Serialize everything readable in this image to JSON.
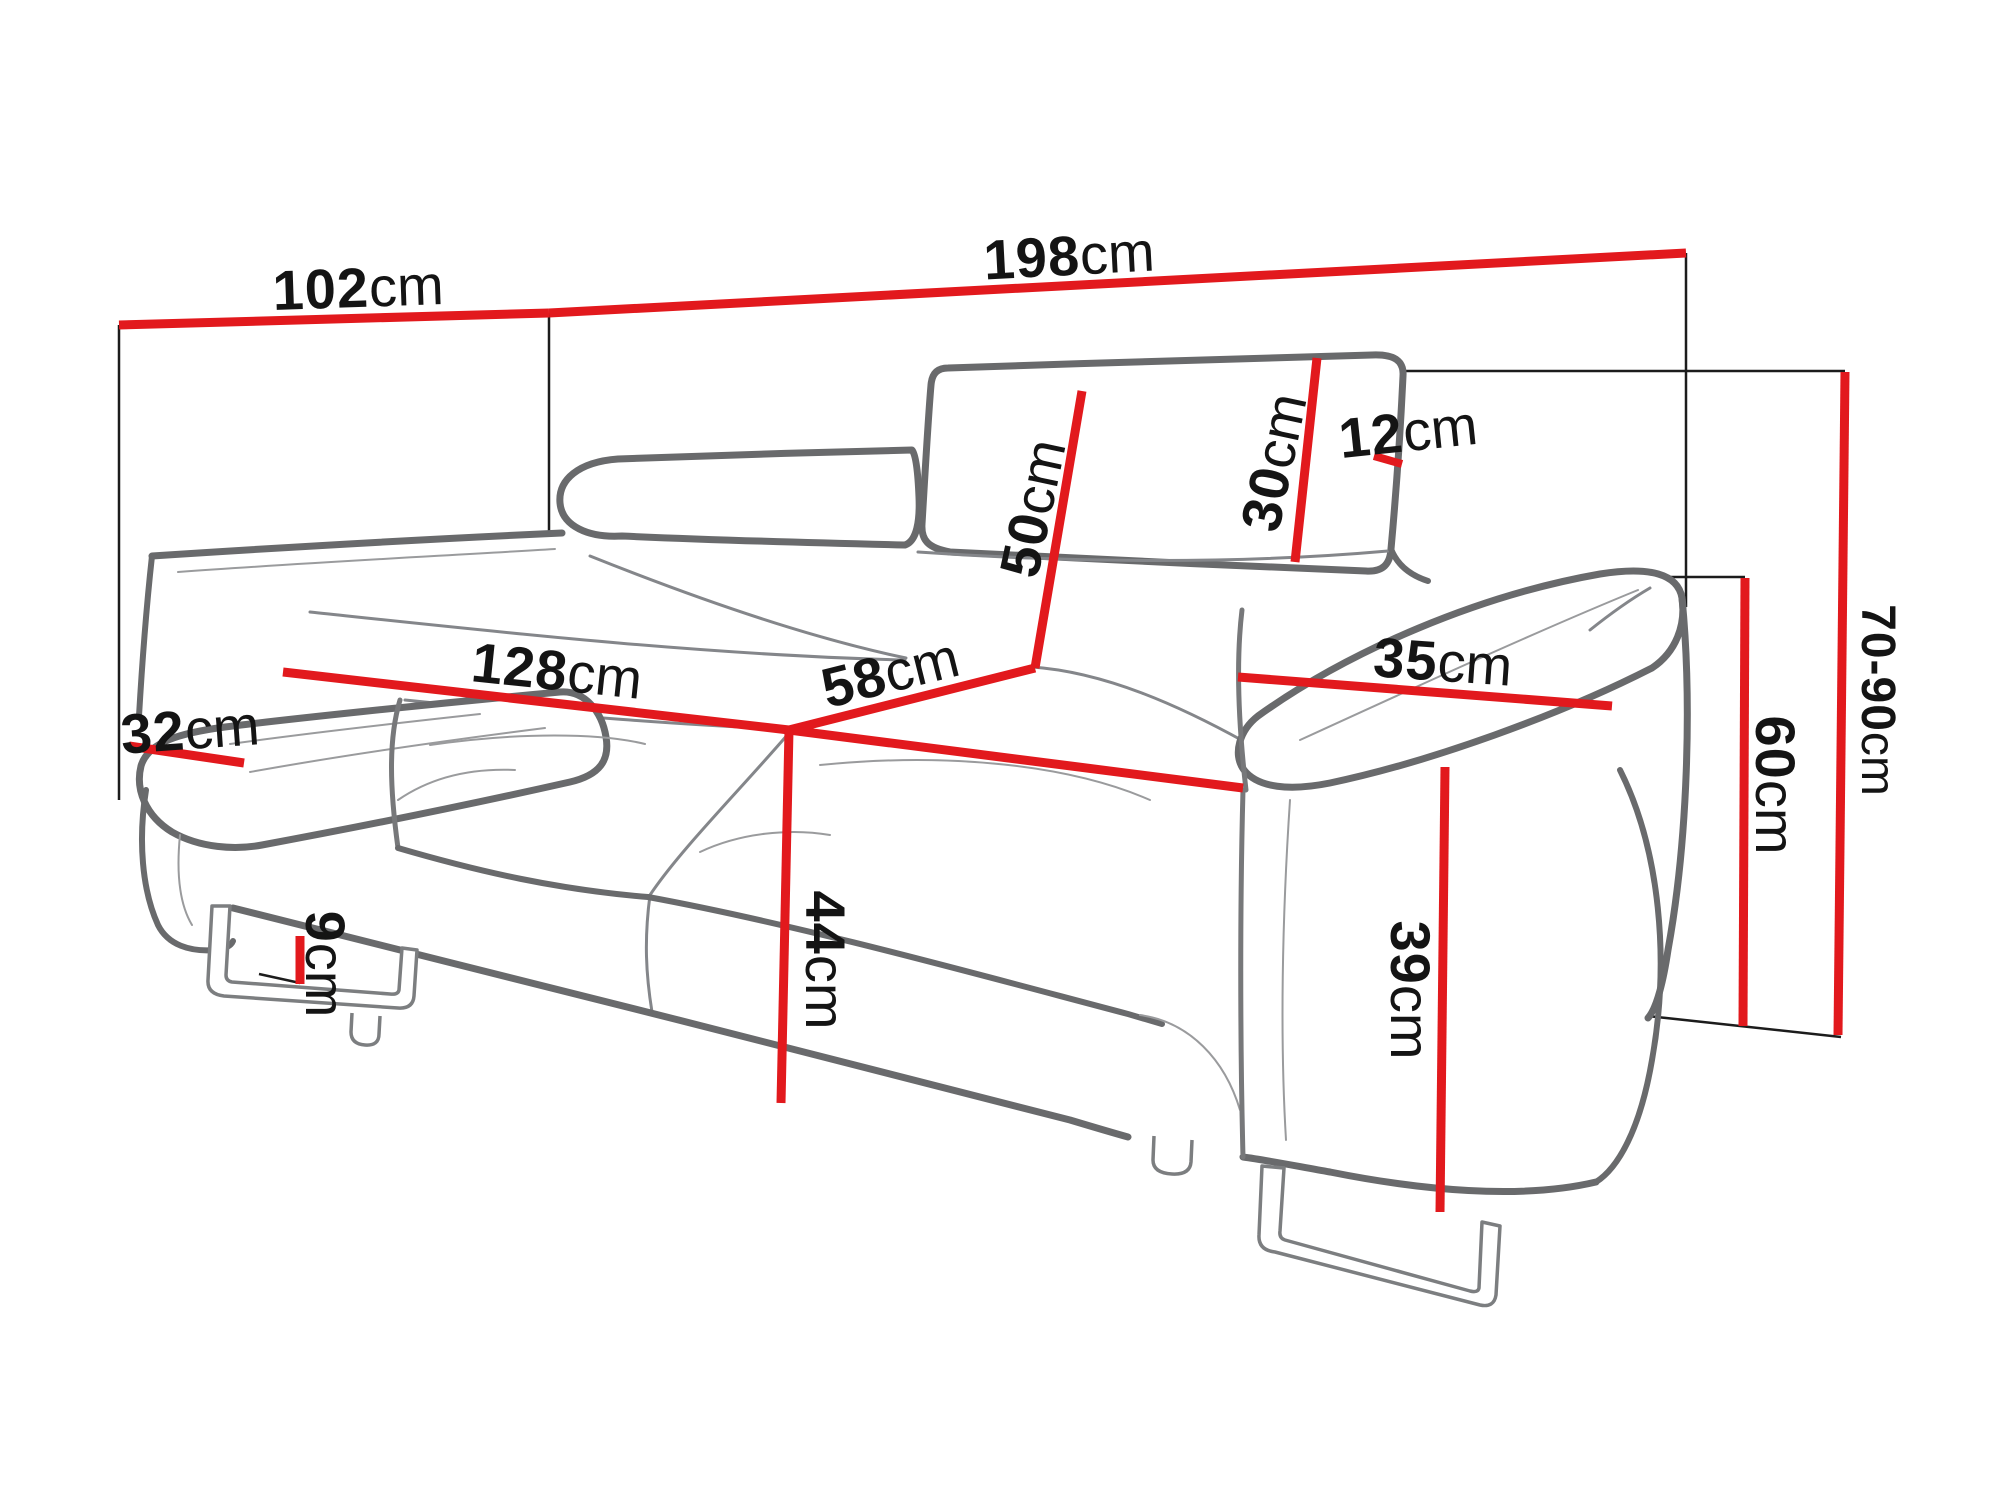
{
  "diagram": {
    "subject": "two-seat sofa dimension drawing",
    "colors": {
      "accent": "#e2191d",
      "outline": "#696a6c",
      "text": "#141414",
      "background": "#ffffff"
    },
    "dims": {
      "d102": {
        "value": "102",
        "unit": "cm"
      },
      "d198": {
        "value": "198",
        "unit": "cm"
      },
      "d12": {
        "value": "12",
        "unit": "cm"
      },
      "d30": {
        "value": "30",
        "unit": "cm"
      },
      "d50": {
        "value": "50",
        "unit": "cm"
      },
      "d7090": {
        "value": "70-90",
        "unit": "cm"
      },
      "d35": {
        "value": "35",
        "unit": "cm"
      },
      "d60": {
        "value": "60",
        "unit": "cm"
      },
      "d128": {
        "value": "128",
        "unit": "cm"
      },
      "d58": {
        "value": "58",
        "unit": "cm"
      },
      "d32": {
        "value": "32",
        "unit": "cm"
      },
      "d44": {
        "value": "44",
        "unit": "cm"
      },
      "d9": {
        "value": "9",
        "unit": "cm"
      },
      "d39": {
        "value": "39",
        "unit": "cm"
      }
    }
  }
}
